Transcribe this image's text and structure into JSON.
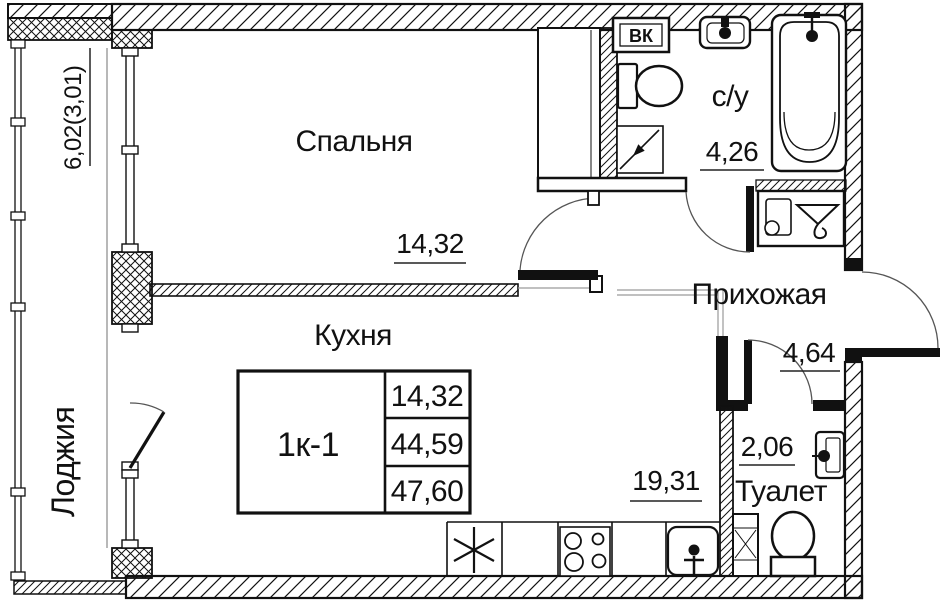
{
  "rooms": {
    "bedroom": {
      "name": "Спальня",
      "area": "14,32"
    },
    "kitchen": {
      "name": "Кухня",
      "area": "19,31"
    },
    "loggia": {
      "name": "Лоджия",
      "area": "6,02(3,01)"
    },
    "bathroom": {
      "name": "с/у",
      "area": "4,26"
    },
    "hallway": {
      "name": "Прихожая",
      "area": "4,64"
    },
    "toilet": {
      "name": "Туалет",
      "area": "2,06"
    }
  },
  "apartment_table": {
    "unit_label": "1к-1",
    "values": [
      "14,32",
      "44,59",
      "47,60"
    ]
  },
  "duct_label": "ВК",
  "colors": {
    "line": "#111111",
    "secondary": "#9a9a9a",
    "background": "#ffffff"
  }
}
